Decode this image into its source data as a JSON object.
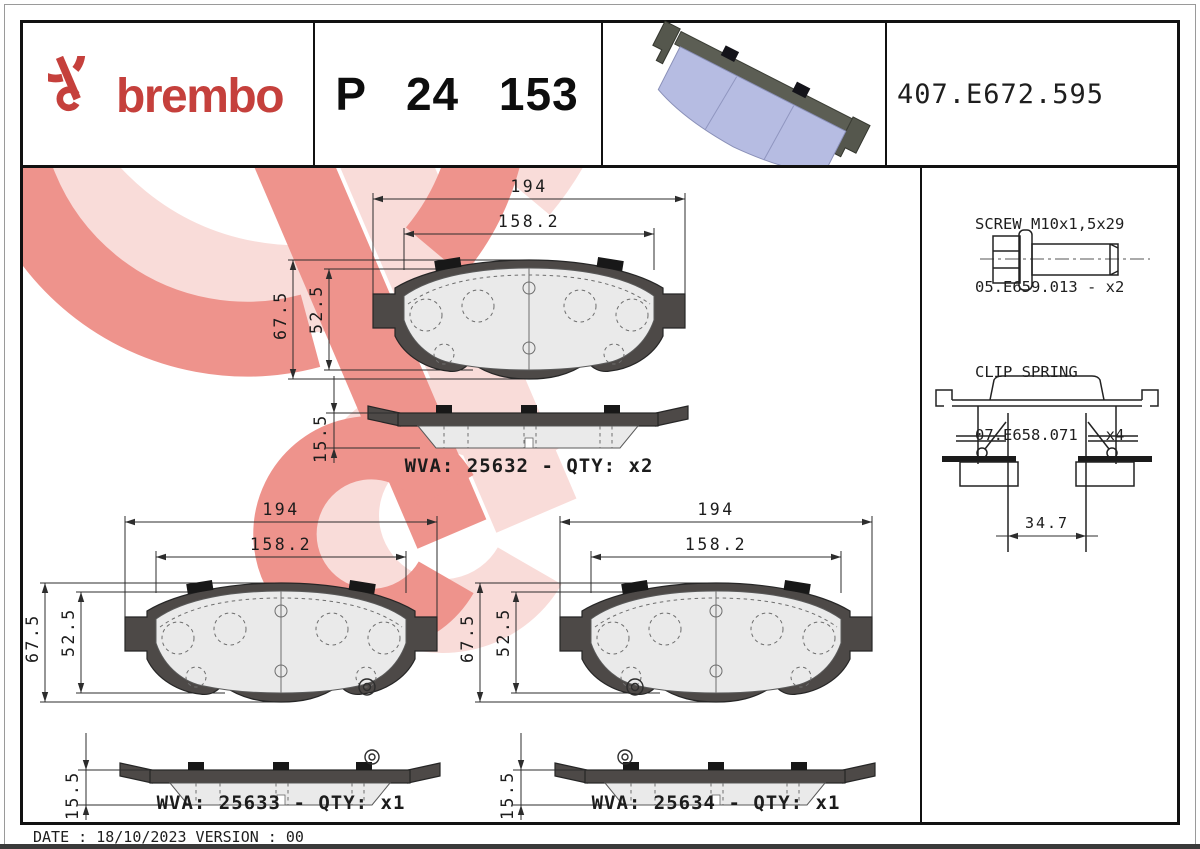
{
  "header": {
    "brand_wordmark": "brembo",
    "part_number": "P 24 153",
    "reference_number": "407.E672.595"
  },
  "dimensions": {
    "total_width": "194",
    "friction_width": "158.2",
    "total_height": "67.5",
    "friction_height": "52.5",
    "thickness": "15.5"
  },
  "variants": [
    {
      "wva": "WVA: 25632 - QTY: x2"
    },
    {
      "wva": "WVA: 25633 - QTY: x1"
    },
    {
      "wva": "WVA: 25634 - QTY: x1"
    }
  ],
  "accessories": {
    "screw_title": "SCREW M10x1,5x29",
    "screw_ref": "05.E659.013 - x2",
    "clip_title": "CLIP SPRING",
    "clip_ref": "07.E658.071 - x4",
    "clip_width": "34.7"
  },
  "footer": {
    "date_version": "DATE : 18/10/2023 VERSION : 00"
  },
  "colors": {
    "brand-red": "#c5403c",
    "watermark-red": "#ee938c",
    "watermark-pink": "#f9dcd9",
    "pad-face": "#b6bce2",
    "backplate-gray": "#4d4947"
  }
}
